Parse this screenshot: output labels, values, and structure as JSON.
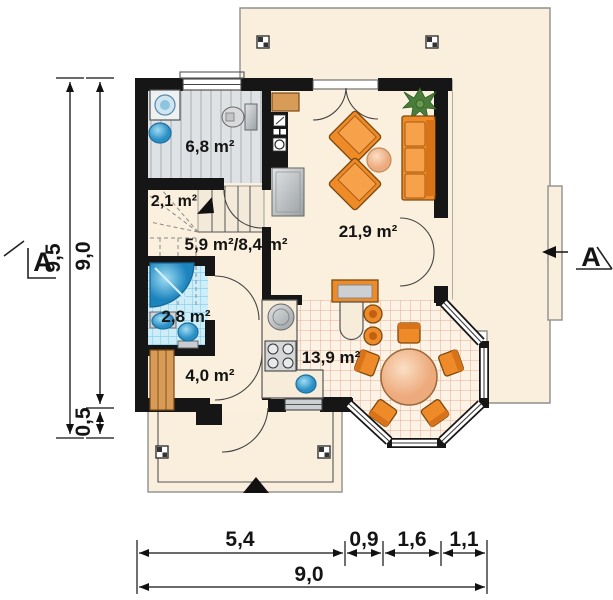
{
  "colors": {
    "wall": "#161616",
    "floor": "#fbf0de",
    "terrace": "#faefdc",
    "orange": "#ef8a28",
    "orange-dark": "#7a4a10",
    "wood": "#d99c58",
    "gray-floor": "#dfe2e4",
    "blue-tile": "#cdeef9",
    "warm-tile": "#fdf2e6"
  },
  "rooms": [
    {
      "id": "utility-bathroom",
      "area": "6,8 m²"
    },
    {
      "id": "under-stairs",
      "area": "2,1 m²"
    },
    {
      "id": "hall-stairs",
      "area": "5,9 m²/8,4 m²"
    },
    {
      "id": "living-room",
      "area": "21,9 m²"
    },
    {
      "id": "bathroom",
      "area": "2,8 m²"
    },
    {
      "id": "wardrobe",
      "area": "4,0 m²"
    },
    {
      "id": "kitchen-dining",
      "area": "13,9 m²"
    }
  ],
  "dimensions": {
    "left": [
      "9,5",
      "9,0",
      "0,5"
    ],
    "bottom": [
      "5,4",
      "0,9",
      "1,6",
      "1,1"
    ],
    "bottom_total": "9,0"
  },
  "section": {
    "label": "A"
  }
}
